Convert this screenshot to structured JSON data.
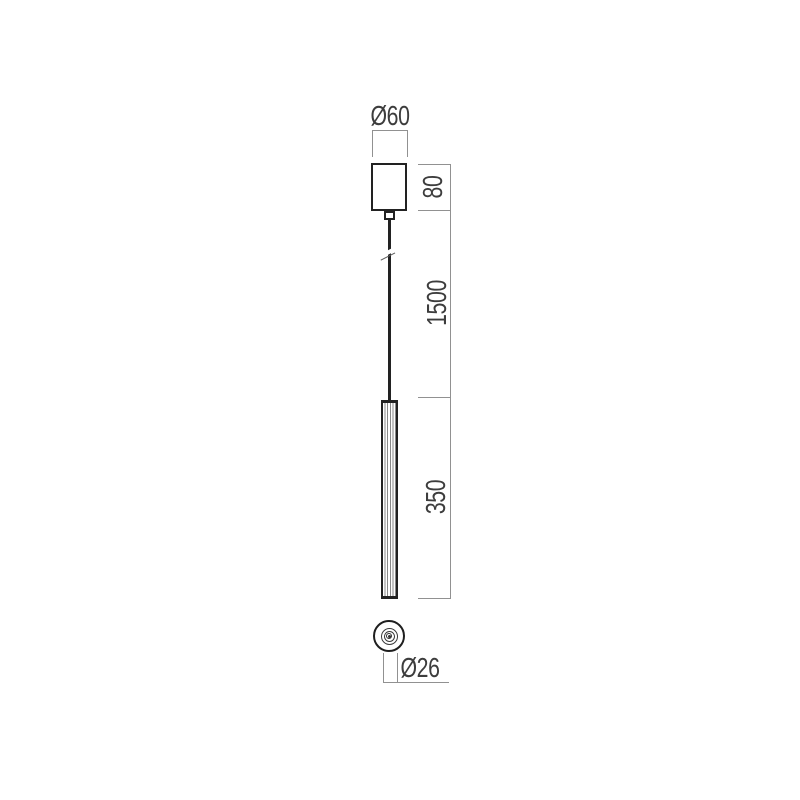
{
  "drawing": {
    "kind": "pendant-lamp-technical-dimension-drawing",
    "views": {
      "front": "side elevation with canopy, suspension cable and tube",
      "bottom": "circular bottom view with concentric rings"
    },
    "dimensions": [
      {
        "id": "canopy_diameter",
        "label": "Ø60",
        "value_mm": 60,
        "orientation": "horizontal",
        "applies_to": "ceiling canopy width"
      },
      {
        "id": "canopy_height",
        "label": "80",
        "value_mm": 80,
        "orientation": "vertical",
        "applies_to": "ceiling canopy height"
      },
      {
        "id": "suspension_length",
        "label": "1500",
        "value_mm": 1500,
        "orientation": "vertical",
        "applies_to": "suspension cable length"
      },
      {
        "id": "tube_length",
        "label": "350",
        "value_mm": 350,
        "orientation": "vertical",
        "applies_to": "lamp tube length"
      },
      {
        "id": "tube_diameter",
        "label": "Ø26",
        "value_mm": 26,
        "orientation": "horizontal",
        "applies_to": "lamp tube diameter (bottom view)"
      }
    ],
    "colors": {
      "background": "#ffffff",
      "object_line": "#222222",
      "dimension_line": "#919191",
      "dimension_text": "#3d3d3d"
    }
  }
}
